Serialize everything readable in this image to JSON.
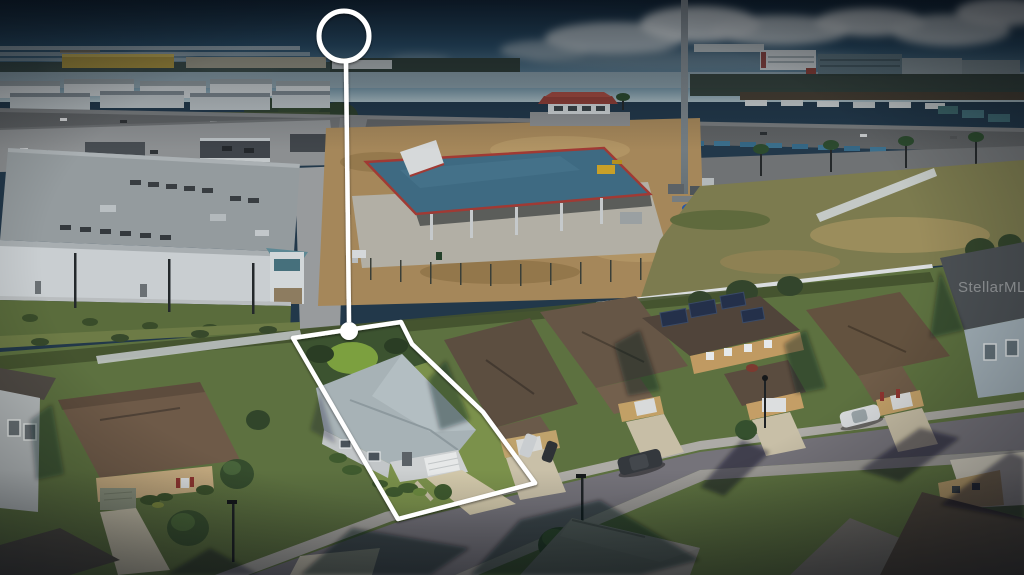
{
  "watermark": "StellarMLS",
  "annotation": {
    "stroke_color": "#ffffff",
    "circle": {
      "cx": 344,
      "cy": 36,
      "r": 25
    },
    "line": {
      "x1": 346,
      "y1": 61,
      "x2": 349,
      "y2": 322
    },
    "dot": {
      "cx": 349,
      "cy": 331,
      "r": 9
    },
    "lot_points": "293,338 401,322 412,344 483,412 535,483 398,519"
  },
  "palette": {
    "sky_top": "#14283a",
    "sky_horizon": "#a9bcc2",
    "grass": "#5d7140",
    "subject_lawn": "#7b914b",
    "dirt": "#a5875a",
    "asphalt": "#75737a",
    "warehouse_wall": "#c9ced1",
    "metal_roof_blue": "#3e6a82",
    "trim_red": "#a03a34",
    "subject_roof": "#a7b2b6",
    "annotation_white": "#ffffff"
  }
}
